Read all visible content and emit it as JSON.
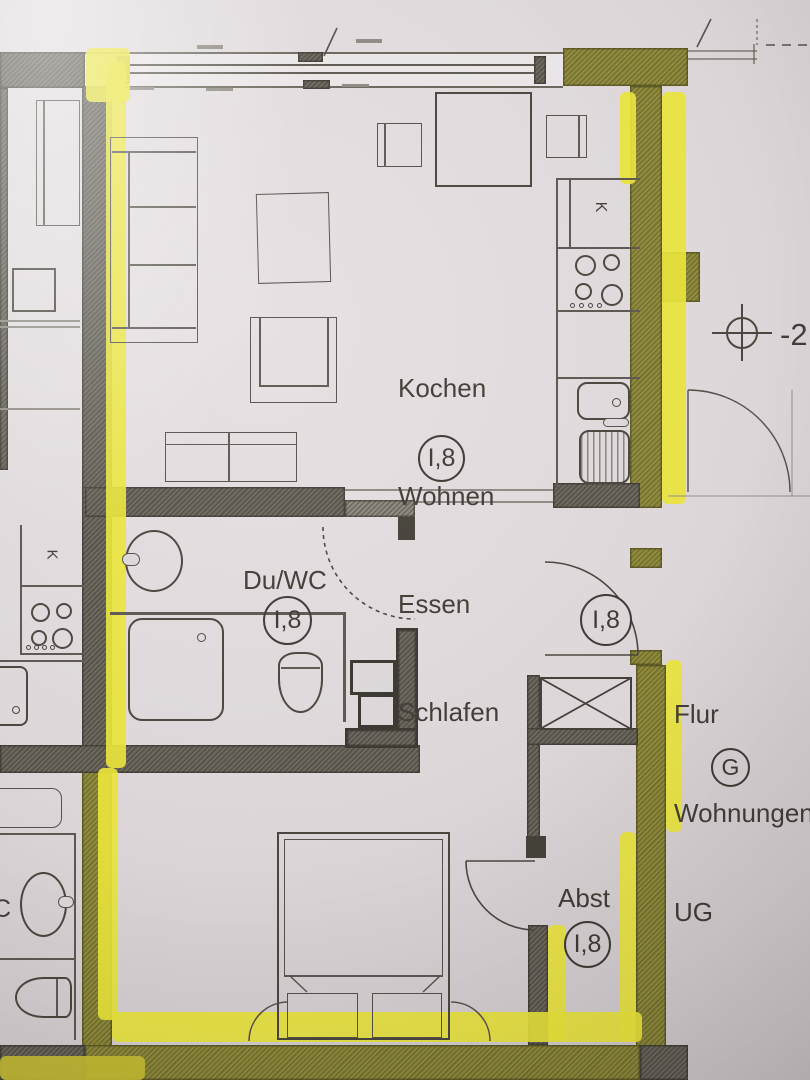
{
  "photo": {
    "paper_color": "#ded8da",
    "highlight_bright": "#e9e43c",
    "highlight_olive": "#8f8a3c",
    "wall_gray": "#6b675d",
    "ink_color": "#413e38"
  },
  "labels": {
    "main_room": {
      "lines": [
        "Kochen",
        "Wohnen",
        "Essen",
        "Schlafen"
      ],
      "tag": "I,8"
    },
    "bath": {
      "name": "Du/WC",
      "tag": "I,8"
    },
    "entrance": {
      "tag": "I,8"
    },
    "storage": {
      "name": "Abst",
      "tag": "I,8"
    },
    "corridor": {
      "lines": [
        "Flur",
        "Wohnungen",
        "UG"
      ],
      "tag": "G"
    },
    "elevation": "-2,",
    "fridge_right": "K",
    "fridge_left": "K",
    "wc_partial": "C"
  }
}
